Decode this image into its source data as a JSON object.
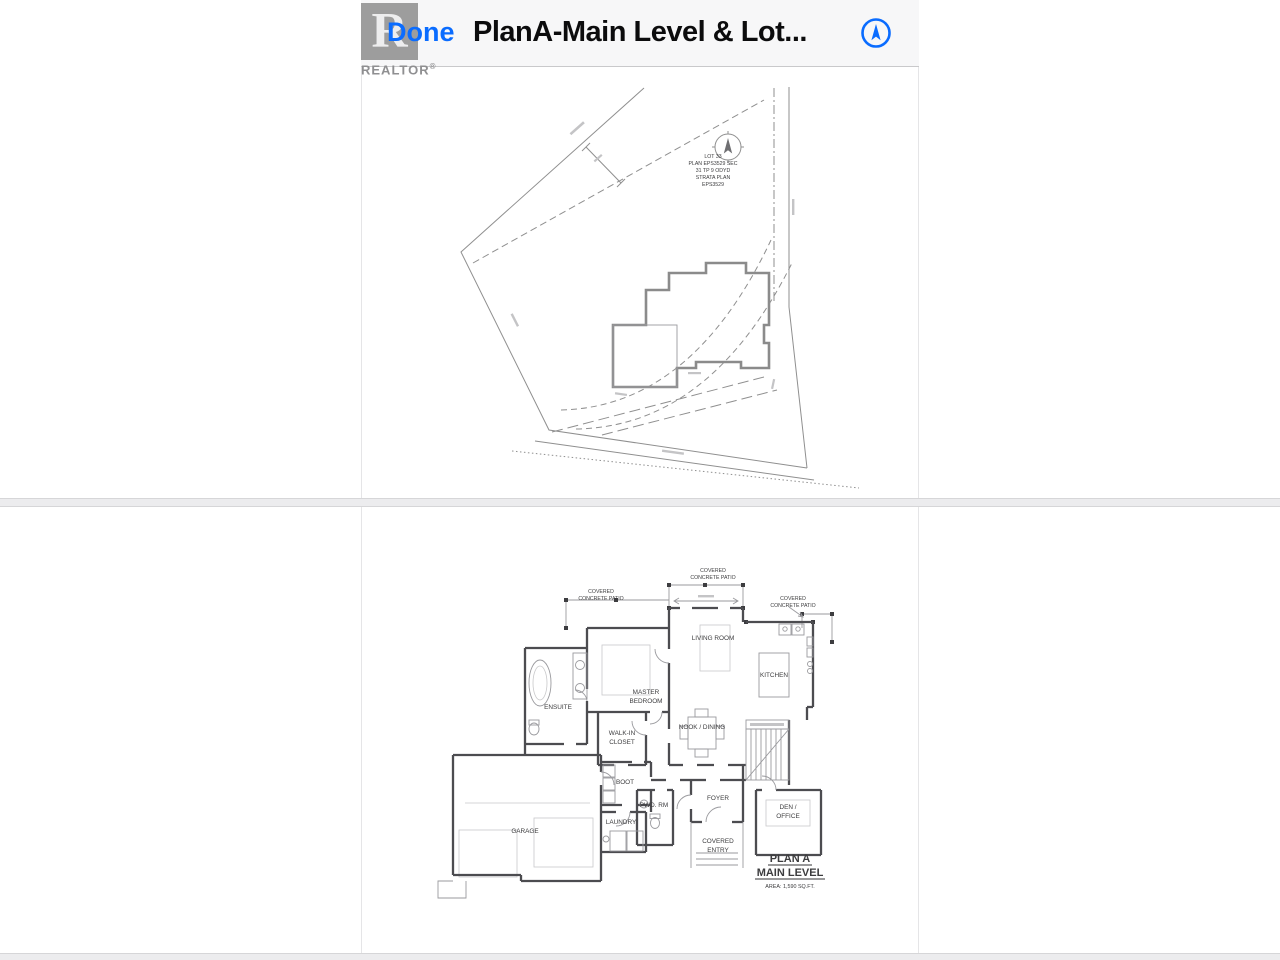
{
  "header": {
    "done_label": "Done",
    "title": "PlanA-Main Level & Lot..."
  },
  "watermark": {
    "logo_letter": "R",
    "brand": "REALTOR",
    "registered": "®"
  },
  "colors": {
    "accent_blue": "#0a6cff",
    "wall_gray": "#4c4c50"
  },
  "lot_plan": {
    "text_block": {
      "l1": "LOT 33",
      "l2": "PLAN EPS3529 SEC",
      "l3": "31 TP 9 ODYD",
      "l4": "STRATA PLAN",
      "l5": "EPS3529"
    }
  },
  "floor_plan": {
    "patio_top_1": "COVERED",
    "patio_top_2": "CONCRETE PATIO",
    "patio_left_1": "COVERED",
    "patio_left_2": "CONCRETE PATIO",
    "patio_right_1": "COVERED",
    "patio_right_2": "CONCRETE PATIO",
    "living_room": "LIVING ROOM",
    "master_1": "MASTER",
    "master_2": "BEDROOM",
    "ensuite": "ENSUITE",
    "kitchen": "KITCHEN",
    "nook": "NOOK / DINING",
    "closet_1": "WALK-IN",
    "closet_2": "CLOSET",
    "boot": "BOOT",
    "garage": "GARAGE",
    "laundry": "LAUNDRY",
    "powder": "PWD. RM",
    "foyer": "FOYER",
    "entry_1": "COVERED",
    "entry_2": "ENTRY",
    "den_1": "DEN /",
    "den_2": "OFFICE",
    "plan_title": "PLAN A",
    "plan_subtitle": "MAIN LEVEL",
    "plan_area": "AREA: 1,590 SQ.FT."
  }
}
